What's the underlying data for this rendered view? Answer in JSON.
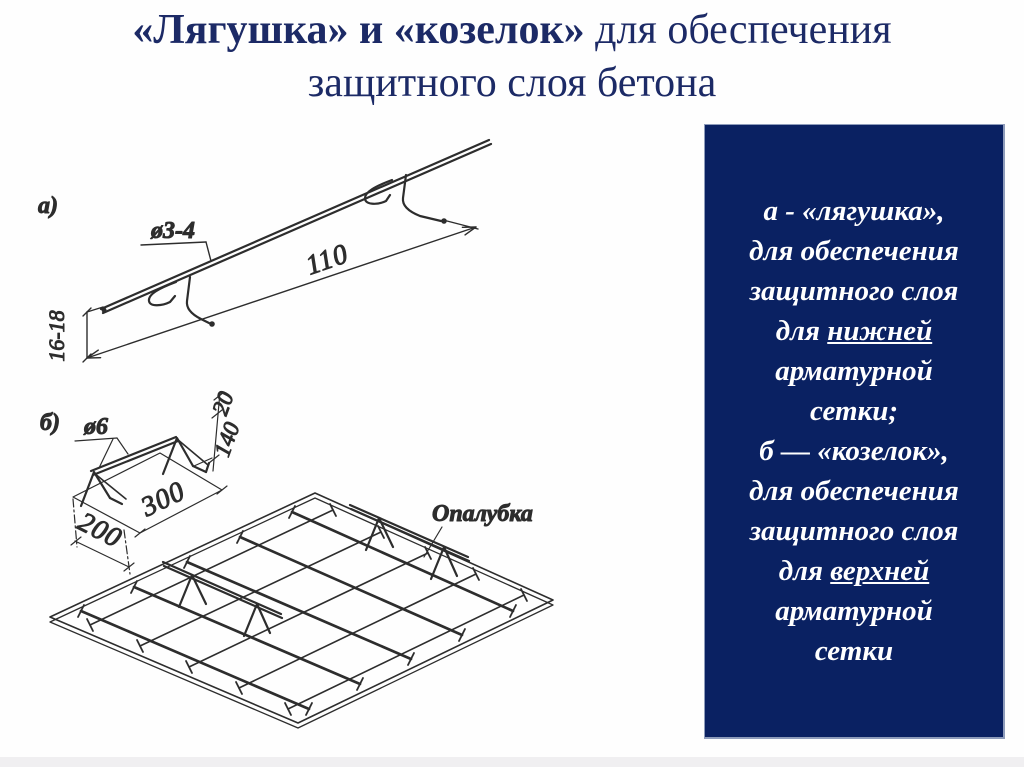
{
  "title": {
    "bold": "«Лягушка» и «козелок»",
    "regular": " для обеспечения",
    "line2": "защитного слоя бетона"
  },
  "panel": {
    "bg_color": "#0a2162",
    "text_color": "#ffffff",
    "lines": [
      {
        "t": "а - «лягушка»,"
      },
      {
        "t": "для обеспечения"
      },
      {
        "t": "защитного слоя"
      },
      {
        "pre": "для ",
        "u": "нижней"
      },
      {
        "t": "арматурной"
      },
      {
        "t": "сетки;"
      },
      {
        "t": "б — «козелок»,"
      },
      {
        "t": "для обеспечения"
      },
      {
        "t": "защитного слоя"
      },
      {
        "pre": "для ",
        "u": "верхней"
      },
      {
        "t": "арматурной"
      },
      {
        "t": "сетки"
      }
    ]
  },
  "figure": {
    "part_a_label": "а)",
    "part_a_diameter": "ø3-4",
    "part_a_length": "110",
    "part_a_height": "16-18",
    "part_b_label": "б)",
    "part_b_diameter": "ø6",
    "part_b_length": "300",
    "part_b_width": "200",
    "part_b_leg": "140",
    "part_b_hook": "20",
    "formwork_label": "Опалубка"
  },
  "colors": {
    "title_text": "#1c2a66",
    "panel_bg": "#0a2162",
    "panel_border": "#8e9cbb",
    "ink": "#2d2d2d",
    "background": "#fefefe"
  }
}
